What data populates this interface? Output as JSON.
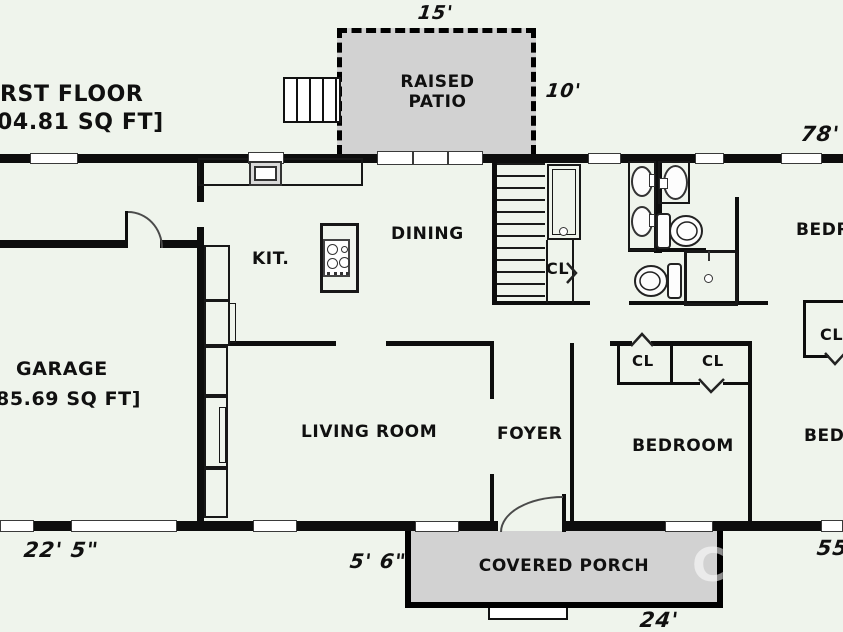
{
  "plan": {
    "title_line1": "RST FLOOR",
    "title_line2": "04.81 SQ FT]",
    "watermark_letter": "C"
  },
  "rooms": {
    "raised_patio": "RAISED PATIO",
    "kitchen": "KIT.",
    "dining": "DINING",
    "garage": "GARAGE",
    "garage_area": "85.69 SQ FT]",
    "living_room": "LIVING ROOM",
    "foyer": "FOYER",
    "bedroom_center": "BEDROOM",
    "bedroom_top_right": "BEDROOM",
    "bedroom_bottom_right": "BEDROOM",
    "covered_porch": "COVERED PORCH"
  },
  "closets": {
    "hall_closet": "CL",
    "bedroom_closet_left": "CL",
    "bedroom_closet_right": "CL",
    "right_bedroom_closet": "CL"
  },
  "dimensions": {
    "patio_width": "15'",
    "patio_depth": "10'",
    "overall_width": "78'",
    "garage_side": "22' 5\"",
    "porch_left_offset": "5' 6\"",
    "porch_width": "24'",
    "right_side": "55'"
  },
  "colors": {
    "background": "#eff4ec",
    "wall": "#0d0d0d",
    "patio_fill": "#d2d2d2",
    "porch_fill": "#d2d2d2"
  }
}
